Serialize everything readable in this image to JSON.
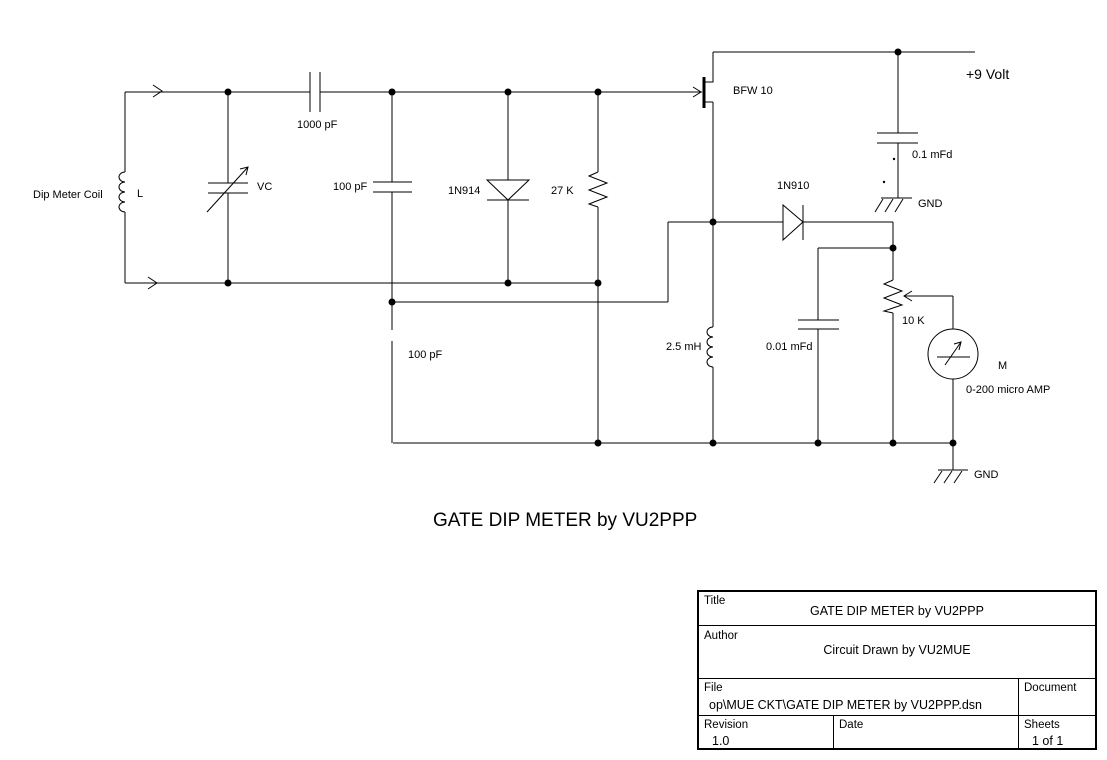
{
  "schematic": {
    "caption": "GATE DIP METER by VU2PPP",
    "labels": {
      "dip_meter_coil": "Dip Meter Coil",
      "inductor_l": "L",
      "variable_capacitor": "VC",
      "cap_1000pf": "1000 pF",
      "cap_100pf_top": "100 pF",
      "diode_1n914": "1N914",
      "resistor_27k": "27 K",
      "transistor_bfw10": "BFW 10",
      "supply_9v": "+9 Volt",
      "cap_0_1mfd": "0.1 mFd",
      "gnd_top": "GND",
      "diode_1n910": "1N910",
      "inductor_2_5mh": "2.5 mH",
      "cap_100pf_bottom": "100 pF",
      "cap_0_01mfd": "0.01 mFd",
      "pot_10k": "10 K",
      "meter_m": "M",
      "meter_range": "0-200 micro AMP",
      "gnd_bottom": "GND"
    }
  },
  "title_block": {
    "title_label": "Title",
    "title_value": "GATE DIP METER by VU2PPP",
    "author_label": "Author",
    "author_value": "Circuit Drawn by VU2MUE",
    "file_label": "File",
    "file_value": "op\\MUE CKT\\GATE DIP METER by VU2PPP.dsn",
    "document_label": "Document",
    "revision_label": "Revision",
    "revision_value": "1.0",
    "date_label": "Date",
    "date_value": "",
    "sheets_label": "Sheets",
    "sheets_value": "1 of 1"
  }
}
